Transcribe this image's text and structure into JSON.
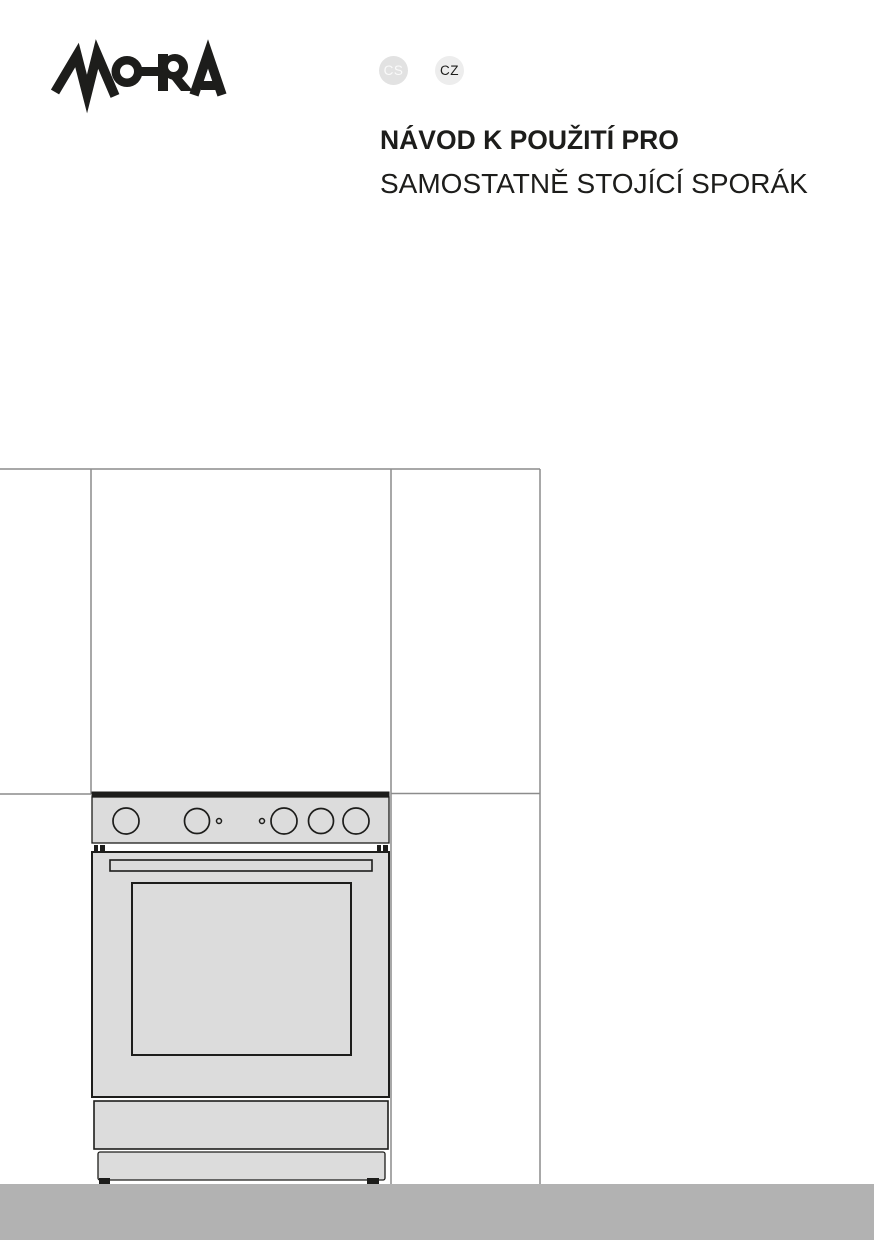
{
  "document": {
    "type": "user-manual-cover",
    "brand": "MORA",
    "title_line1": "NÁVOD K POUŽITÍ PRO",
    "title_line2": "SAMOSTATNĚ STOJÍCÍ SPORÁK"
  },
  "header": {
    "language_badges": [
      {
        "label": "CS"
      },
      {
        "label": "CZ"
      }
    ]
  },
  "illustration": {
    "label": "line drawing of a freestanding cooker standing between kitchen counters on a gray floor",
    "knob_count": 5,
    "indicator_dot_count": 2
  },
  "colors": {
    "page_bg": "#ffffff",
    "ink": "#1d1d1b",
    "badge_cs_bg": "#e2e2e2",
    "badge_cs_text": "#fafafa",
    "badge_cz_bg": "#ededed",
    "badge_cz_text": "#1d1d1b",
    "stove_fill": "#dcdcdc",
    "wall_line": "#8c8c8c",
    "floor_fill": "#b2b2b2"
  }
}
